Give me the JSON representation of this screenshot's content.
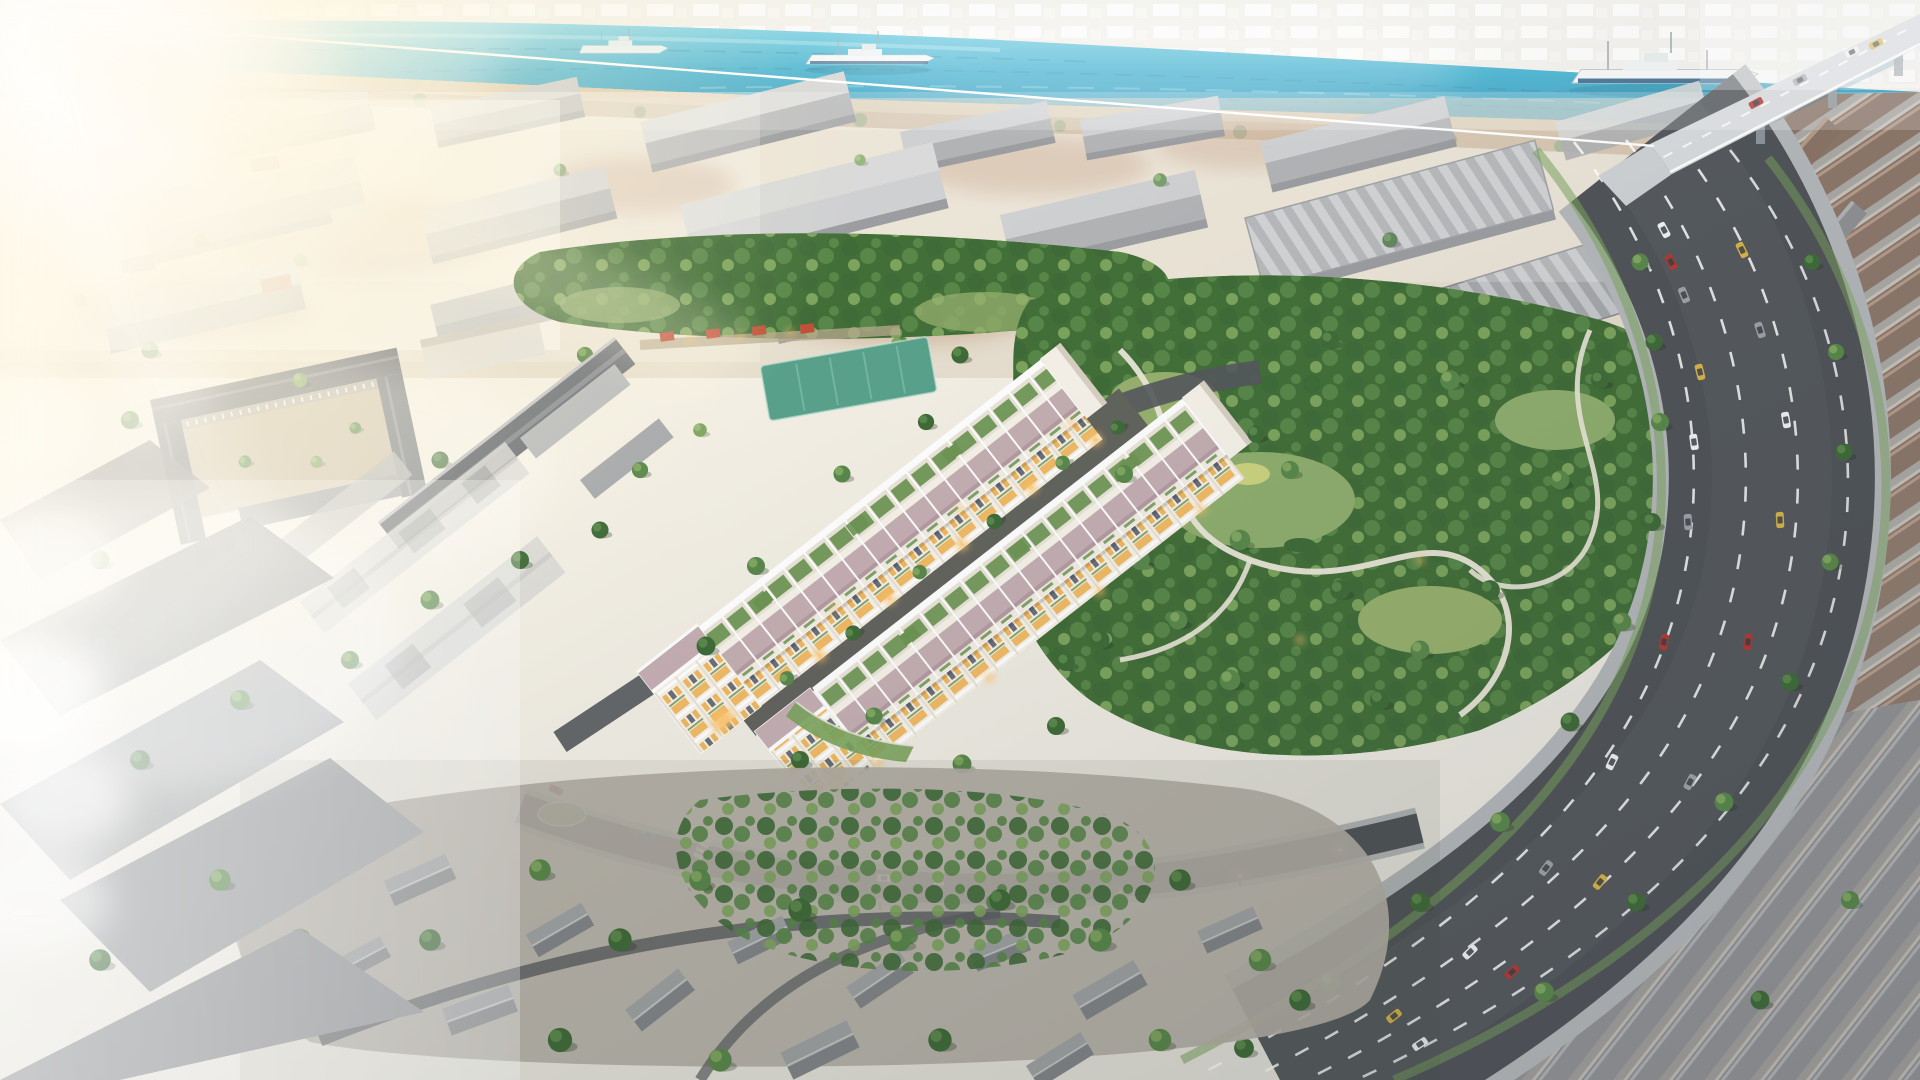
{
  "scene": {
    "setting": "Aerial 3D rendering of a riverside urban district at golden hour",
    "focal_point": "Two long rows of white shophouse townhouses with lavender tiled roofs, rooftop garden terraces and warm courtyard lighting",
    "regions": [
      "river",
      "cargo-ships",
      "bridge",
      "far-city-skyline",
      "industrial-warehouses",
      "market-street",
      "sports-field",
      "school-campus",
      "central-park",
      "townhouse-development",
      "corner-shophouse",
      "main-avenue",
      "side-street",
      "terraced-neighborhood",
      "low-rise-neighborhood",
      "context-massing-blocks",
      "smoke-plumes",
      "sun-flare"
    ],
    "ship_count": 3,
    "lighting": "strong warm sun flare from upper-left, dusk ambience lower-right"
  },
  "palette": {
    "sky_top": "#fdf9ee",
    "sky_mid": "#f3efe4",
    "sky_bot": "#e9e7df",
    "river_light": "#79d2e6",
    "river": "#2fa9cb",
    "river_deep": "#1f87ad",
    "far_city": "#e7e4db",
    "bank_sand": "#d8c5a4",
    "bank_dirt": "#c2a687",
    "dirt_red": "#bb9273",
    "wh_roof_light": "#c3c5c7",
    "wh_roof_dark": "#9ea0a3",
    "wh_wall": "#82858a",
    "wh_pale": "#d0d1d0",
    "tree_dark": "#3f6b38",
    "tree_mid": "#59884a",
    "tree_light": "#7fa75f",
    "tree_pale": "#9db87f",
    "lawn": "#8fae6d",
    "lawn2": "#97b06d",
    "field_teal": "#58a18b",
    "canopy_base": "#426f38",
    "path_park": "#ece8da",
    "th_wall": "#f6f2e9",
    "th_roof": "#c4aeb2",
    "th_terrace_floor": "#eae4d8",
    "terrace_green": "#6d9553",
    "parapet": "#ffffff",
    "window_warm": "#f0b85e",
    "window_dark": "#6b6f76",
    "glow": "#ffc46a",
    "glow_core": "#ffd27a",
    "asphalt": "#505458",
    "asphalt_dark": "#4b4e52",
    "lane": "#ffffff",
    "sidewalk": "#b5b8ba",
    "verge": "#7aa45c",
    "bridge_deck": "#d8dbdd",
    "roof_brown": "#8a7466",
    "roof_brown_light": "#b59a88",
    "roof_grey": "#8f9193",
    "house_roof_a": "#a3a5a7",
    "house_roof_b": "#85878a",
    "house_wall": "#d9d7d2",
    "slab_grey": "#9b9c9e",
    "slab_trans": "#dddddb",
    "roof_slate": "#70747b",
    "ground_neigh": "#b7b2a9",
    "kiosk_red": "#c1503a",
    "ship_white": "#f4f6f6",
    "ship_blue": "#2e5d83",
    "smoke": "#ffffff",
    "flare": "#fff3d0",
    "car_white": "#f2f3f3",
    "car_grey": "#9fa3a7",
    "car_red": "#b23a30",
    "car_yellow": "#d8b54a",
    "car_blue": "#3c6ea8"
  }
}
